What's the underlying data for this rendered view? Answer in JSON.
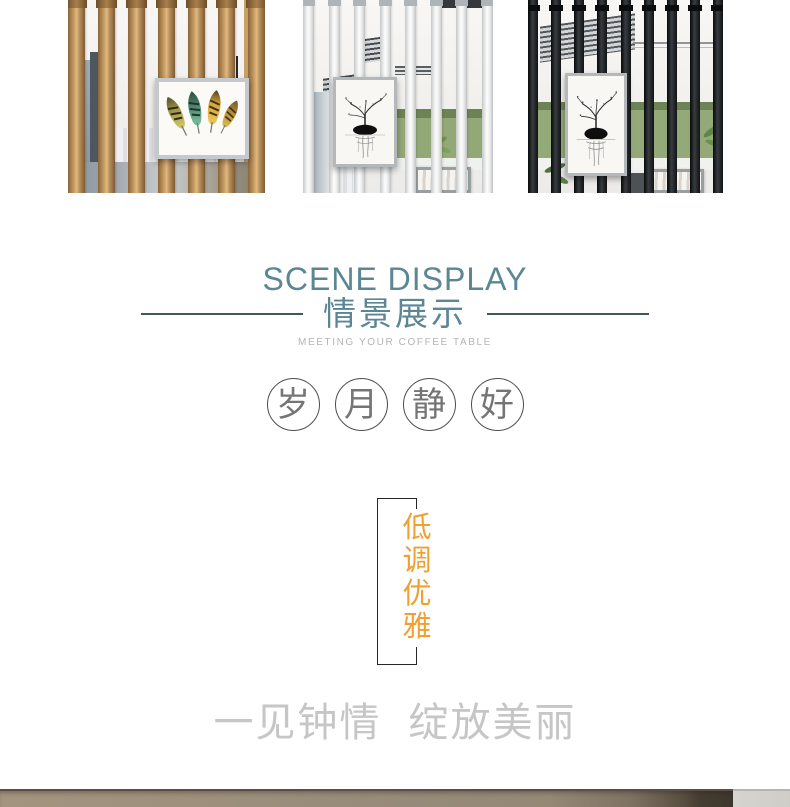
{
  "header": {
    "title_en": "SCENE DISPLAY",
    "title_cn": "情景展示",
    "subtitle": "MEETING YOUR COFFEE TABLE"
  },
  "motto": {
    "text": "岁月静好",
    "chars": [
      "岁",
      "月",
      "静",
      "好"
    ]
  },
  "banner": {
    "text": "低调优雅",
    "chars": [
      "低",
      "调",
      "优",
      "雅"
    ]
  },
  "tagline": {
    "text": "一见钟情 绽放美丽"
  },
  "gallery": {
    "photos": [
      {
        "name": "partition-gold-poles",
        "description": "room divider with gold poles and framed feather artwork"
      },
      {
        "name": "partition-white-poles",
        "description": "room divider with white poles and framed ink-tree artwork"
      },
      {
        "name": "partition-black-poles",
        "description": "room divider with black poles and framed ink-tree artwork"
      }
    ]
  },
  "colors": {
    "heading_teal": "#5b8694",
    "divider_line": "#3e5862",
    "subtitle_gray": "#b5b5b5",
    "motto_gray": "#757575",
    "banner_orange": "#f0a033",
    "tagline_gray": "#c6c6c6",
    "band_wood": "#9a8c79",
    "band_dark": "#3e372d",
    "band_light": "#d1cfca"
  }
}
